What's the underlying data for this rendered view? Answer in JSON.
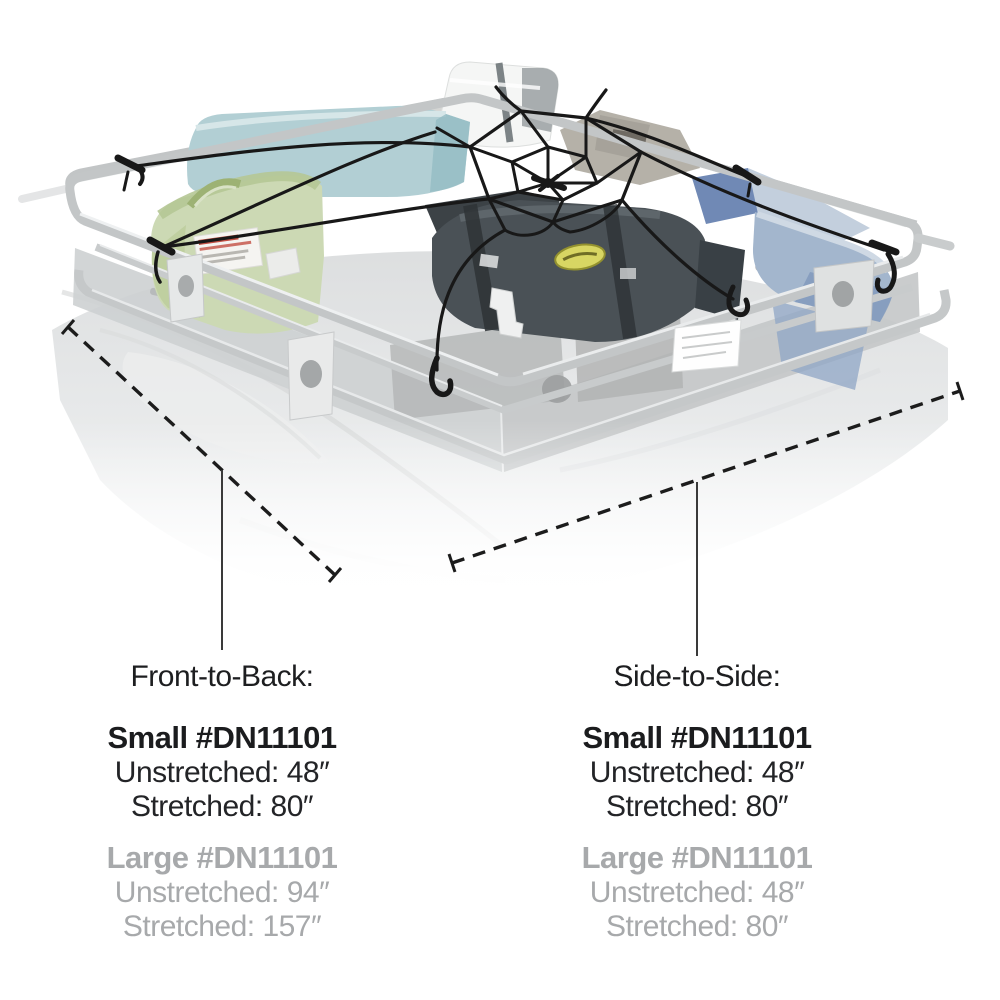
{
  "product_image": {
    "description": "Roof rack basket loaded with duffel bags and coolers, secured by a black spider-web bungee cargo net with six hooks attached to the rack rails",
    "colors": {
      "net_cord": "#181818",
      "rack_tube": "#c3c6c7",
      "teal_bag": "#b2cfd4",
      "green_duffel": "#ccd9b4",
      "dark_duffel": "#4a5156",
      "blue_cooler": "#a3b6cd",
      "white_cooler": "#f5f6f5",
      "logo_badge": "#d8d663",
      "label_red": "#c34f43",
      "dimension_line": "#1c1c1c"
    }
  },
  "dimensions": {
    "text_color": "#232427",
    "muted_color": "#a7a9ab",
    "front_to_back": {
      "label": "Front-to-Back:",
      "small": {
        "name": "Small #DN11101",
        "unstretched": "Unstretched: 48″",
        "stretched": "Stretched: 80″"
      },
      "large": {
        "name": "Large #DN11101",
        "unstretched": "Unstretched: 94″",
        "stretched": "Stretched: 157″"
      }
    },
    "side_to_side": {
      "label": "Side-to-Side:",
      "small": {
        "name": "Small #DN11101",
        "unstretched": "Unstretched: 48″",
        "stretched": "Stretched: 80″"
      },
      "large": {
        "name": "Large #DN11101",
        "unstretched": "Unstretched: 48″",
        "stretched": "Stretched: 80″"
      }
    }
  }
}
